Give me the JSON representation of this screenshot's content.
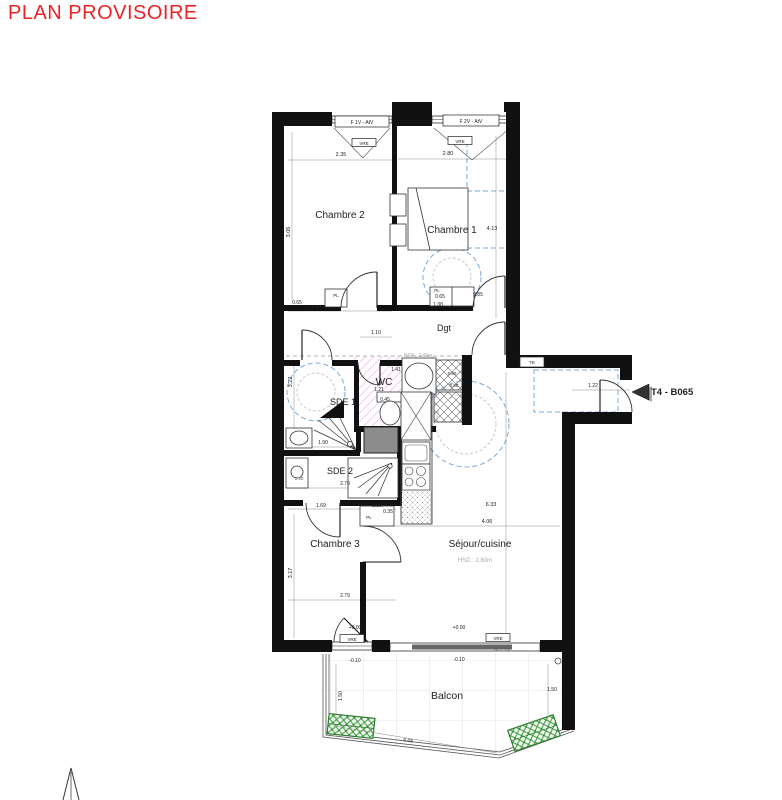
{
  "title": {
    "text": "PLAN PROVISOIRE"
  },
  "unit": {
    "label": "T4 - B065"
  },
  "colors": {
    "accent": "#ec2227",
    "dash_blue": "#7aa9d8",
    "hatch_pink": "#e87fd8",
    "planter_green": "#3f9b3f",
    "wall": "#111111",
    "duct_gray": "#8c8c8c"
  },
  "labels": [
    {
      "id": "window-label-f1v",
      "t": "F 1V - AtV",
      "x": 362,
      "y": 124,
      "s": 5,
      "box": [
        335,
        116,
        54,
        11
      ]
    },
    {
      "id": "window-label-f2v",
      "t": "F 2V - AtV",
      "x": 471,
      "y": 123,
      "s": 5,
      "box": [
        443,
        115,
        56,
        11
      ]
    },
    {
      "id": "vre-window-1",
      "t": "VRE",
      "x": 364,
      "y": 145,
      "s": 4.5,
      "box": [
        352,
        138.5,
        24,
        8
      ]
    },
    {
      "id": "vre-window-2",
      "t": "VRE",
      "x": 460,
      "y": 143,
      "s": 4.5,
      "box": [
        448,
        136.5,
        24,
        8
      ]
    },
    {
      "id": "room-label-chambre2",
      "t": "Chambre 2",
      "x": 340,
      "y": 218,
      "s": 10
    },
    {
      "id": "room-label-chambre1",
      "t": "Chambre 1",
      "x": 452,
      "y": 233,
      "s": 10
    },
    {
      "id": "dim-chambre1-height",
      "t": "4.13",
      "x": 492,
      "y": 230,
      "s": 5.5
    },
    {
      "id": "dim-chambre2-width",
      "t": "2.35",
      "x": 341,
      "y": 156,
      "s": 5.5
    },
    {
      "id": "dim-chambre1-width",
      "t": "2.80",
      "x": 448,
      "y": 155,
      "s": 5.5
    },
    {
      "id": "dim-chambre2-height",
      "t": "3.06",
      "x": 290,
      "y": 232,
      "s": 5.5,
      "r": -90
    },
    {
      "id": "dim-pl-chambre2-a",
      "t": "0.65",
      "x": 297,
      "y": 304,
      "s": 5
    },
    {
      "id": "dim-pl-chambre2-b",
      "t": "1.40",
      "x": 316,
      "y": 309,
      "s": 5
    },
    {
      "id": "pl-label-chambre2",
      "t": "PL",
      "x": 336,
      "y": 297,
      "s": 4.5
    },
    {
      "id": "pl-label-chambre1",
      "t": "PL",
      "x": 437,
      "y": 292,
      "s": 4.5
    },
    {
      "id": "dim-pl-chambre1-a",
      "t": "0.65",
      "x": 440,
      "y": 298,
      "s": 5
    },
    {
      "id": "dim-pl-chambre1-b",
      "t": "1.38",
      "x": 438,
      "y": 306,
      "s": 5
    },
    {
      "id": "dim-pl-chambre1-c",
      "t": "0.85",
      "x": 478,
      "y": 296,
      "s": 5
    },
    {
      "id": "dim-dgt-width",
      "t": "1.10",
      "x": 376,
      "y": 334,
      "s": 5
    },
    {
      "id": "room-label-dgt",
      "t": "Dgt",
      "x": 444,
      "y": 331,
      "s": 9
    },
    {
      "id": "label-hsp",
      "t": "HSP : 2.49m",
      "x": 418,
      "y": 357,
      "s": 5,
      "c": "#aaaaaa"
    },
    {
      "id": "dim-wc-a",
      "t": "1.41",
      "x": 396,
      "y": 371,
      "s": 5
    },
    {
      "id": "dim-wc-b",
      "t": "1.21",
      "x": 379,
      "y": 391,
      "s": 5
    },
    {
      "id": "dim-wc-c",
      "t": "0.45",
      "x": 385,
      "y": 401,
      "s": 5
    },
    {
      "id": "room-label-wc",
      "t": "WC",
      "x": 384,
      "y": 385,
      "s": 10
    },
    {
      "id": "room-label-sde1",
      "t": "SDE 1",
      "x": 343,
      "y": 405,
      "s": 9
    },
    {
      "id": "dim-sde1-height",
      "t": "3.22",
      "x": 292,
      "y": 382,
      "s": 5.5,
      "r": -90
    },
    {
      "id": "dim-shaft-a",
      "t": "0.90",
      "x": 452,
      "y": 375,
      "s": 4.5
    },
    {
      "id": "dim-shaft-b",
      "t": "0.60",
      "x": 454,
      "y": 387,
      "s": 4.5
    },
    {
      "id": "label-te",
      "t": "TE",
      "x": 532,
      "y": 364,
      "s": 4.5,
      "box": [
        520,
        357,
        24,
        10
      ]
    },
    {
      "id": "dim-entry-door",
      "t": "1.22",
      "x": 593,
      "y": 387,
      "s": 5
    },
    {
      "id": "unit-label",
      "t": "T4 - B065",
      "x": 651,
      "y": 395,
      "s": 9.5,
      "w": 1,
      "a": "start"
    },
    {
      "id": "dim-sde1-width",
      "t": "1.90",
      "x": 323,
      "y": 444,
      "s": 5
    },
    {
      "id": "room-label-sde2",
      "t": "SDE 2",
      "x": 340,
      "y": 474,
      "s": 9
    },
    {
      "id": "dim-sde2-width",
      "t": "2.79",
      "x": 345,
      "y": 485,
      "s": 5
    },
    {
      "id": "dim-sde2-basin",
      "t": "1.30",
      "x": 299,
      "y": 480,
      "s": 4.5,
      "c": "#555555"
    },
    {
      "id": "dim-hall-a",
      "t": "1.69",
      "x": 321,
      "y": 507,
      "s": 5
    },
    {
      "id": "dim-hall-b",
      "t": "1.10",
      "x": 377,
      "y": 507,
      "s": 5
    },
    {
      "id": "dim-hall-c",
      "t": "0.35",
      "x": 388,
      "y": 513,
      "s": 5
    },
    {
      "id": "pl-label-chambre3",
      "t": "PL",
      "x": 369,
      "y": 519,
      "s": 4.5
    },
    {
      "id": "room-label-chambre3",
      "t": "Chambre 3",
      "x": 335,
      "y": 547,
      "s": 10
    },
    {
      "id": "dim-chambre3-height",
      "t": "3.17",
      "x": 292,
      "y": 573,
      "s": 5.5,
      "r": -90
    },
    {
      "id": "dim-chambre3-width",
      "t": "2.79",
      "x": 345,
      "y": 597,
      "s": 5
    },
    {
      "id": "room-label-sejour",
      "t": "Séjour/cuisine",
      "x": 480,
      "y": 547,
      "s": 10
    },
    {
      "id": "label-hsd",
      "t": "HSD : 2.60m",
      "x": 475,
      "y": 562,
      "s": 6,
      "c": "#aaaaaa"
    },
    {
      "id": "dim-sejour-height",
      "t": "6.33",
      "x": 491,
      "y": 506,
      "s": 5.5
    },
    {
      "id": "dim-sejour-width",
      "t": "4.06",
      "x": 487,
      "y": 523,
      "s": 5.5
    },
    {
      "id": "level-chambre3",
      "t": "+0.00",
      "x": 355,
      "y": 629,
      "s": 5
    },
    {
      "id": "level-sejour",
      "t": "+0.00",
      "x": 459,
      "y": 629,
      "s": 5
    },
    {
      "id": "vre-window-3",
      "t": "VRE",
      "x": 352,
      "y": 641,
      "s": 4.5,
      "box": [
        340,
        634.5,
        24,
        8
      ]
    },
    {
      "id": "vre-window-4",
      "t": "VRE",
      "x": 498,
      "y": 640,
      "s": 4.5,
      "box": [
        486,
        633.5,
        24,
        8
      ]
    },
    {
      "id": "label-rec",
      "t": "REC 2V",
      "x": 502,
      "y": 651,
      "s": 4.5,
      "c": "#555555"
    },
    {
      "id": "level-balcon-left",
      "t": "-0.10",
      "x": 355,
      "y": 662,
      "s": 5
    },
    {
      "id": "level-balcon-right",
      "t": "-0.10",
      "x": 459,
      "y": 661,
      "s": 5
    },
    {
      "id": "dim-balcon-left",
      "t": "1.50",
      "x": 342,
      "y": 696,
      "s": 5,
      "r": -90
    },
    {
      "id": "dim-balcon-right",
      "t": "1.50",
      "x": 552,
      "y": 691,
      "s": 5
    },
    {
      "id": "room-label-balcon",
      "t": "Balcon",
      "x": 447,
      "y": 699,
      "s": 10.5
    },
    {
      "id": "dim-balcon-width",
      "t": "6.05",
      "x": 408,
      "y": 742,
      "s": 5,
      "r": 9
    }
  ]
}
